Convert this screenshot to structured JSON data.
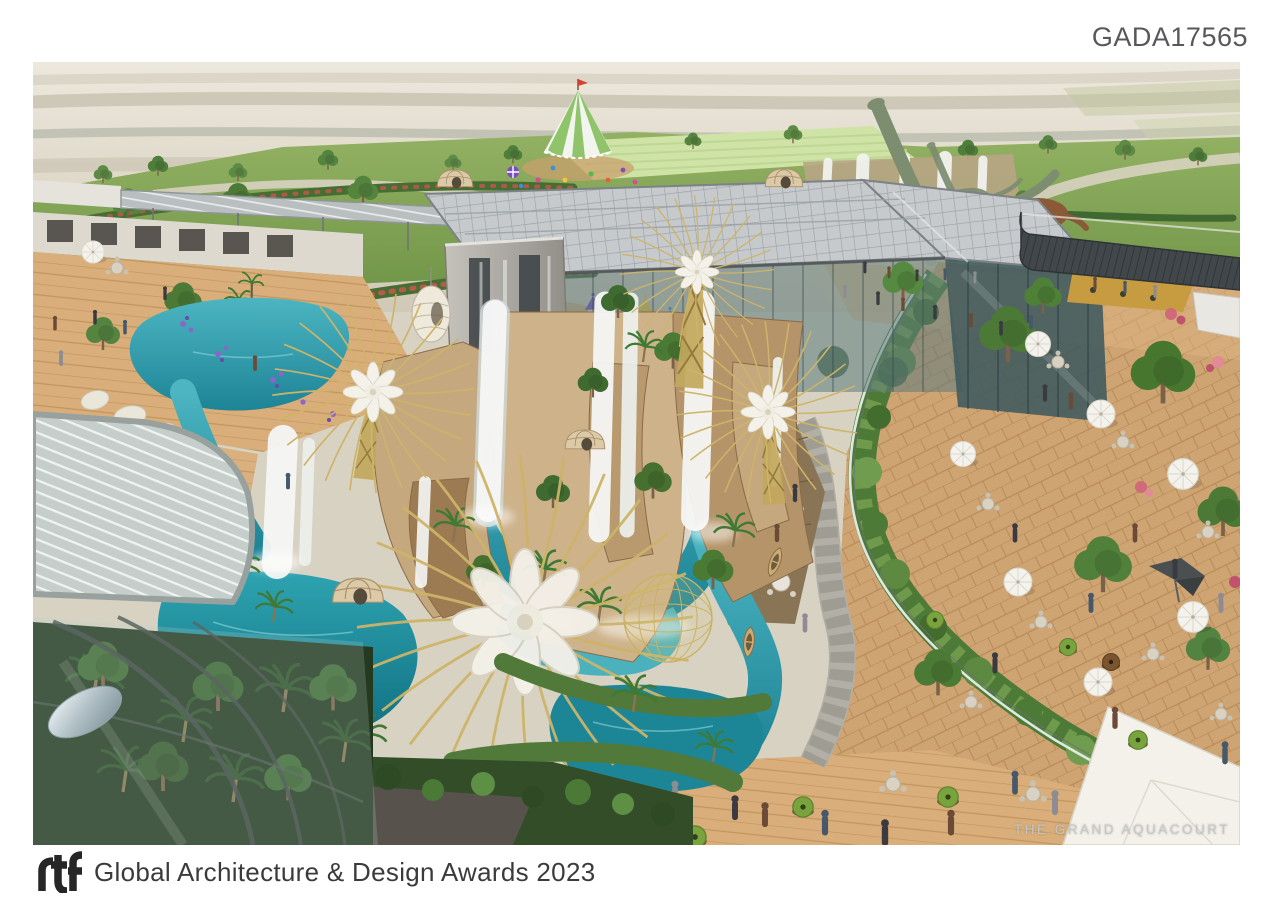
{
  "page": {
    "background_color": "#ffffff"
  },
  "header": {
    "submission_code": "GADA17565",
    "text_color": "#57585b"
  },
  "render": {
    "watermark": "THE GRAND AQUACOURT",
    "palette": {
      "desert": "#d8d2c3",
      "lawn": "#7fa450",
      "water": "#2f9aa8",
      "deep_water": "#13798b",
      "rock": "#c0a077",
      "waterfall": "#f5f6f4",
      "gold_canopy": "#cdb469",
      "deck_wood": "#cfa473",
      "hedge_green": "#4d7a37",
      "glass_roof": "#c6cacc",
      "dark_roof": "#41474b",
      "pouf_green": "#79a33c"
    },
    "scene_elements": [
      "desert-horizon",
      "countryside-fields",
      "amusement-tent",
      "playground",
      "dinosaur-statues",
      "waterfall-glasshouse",
      "rock-waterfalls",
      "lazy-river",
      "boats",
      "golden-supertrees",
      "wicker-domes",
      "terrace-deck",
      "cafe-furniture",
      "visitors",
      "foreground-glass-canopy"
    ]
  },
  "footer": {
    "logo_text": "rtf",
    "award_title": "Global Architecture & Design Awards 2023",
    "text_color": "#3b3b3b"
  }
}
